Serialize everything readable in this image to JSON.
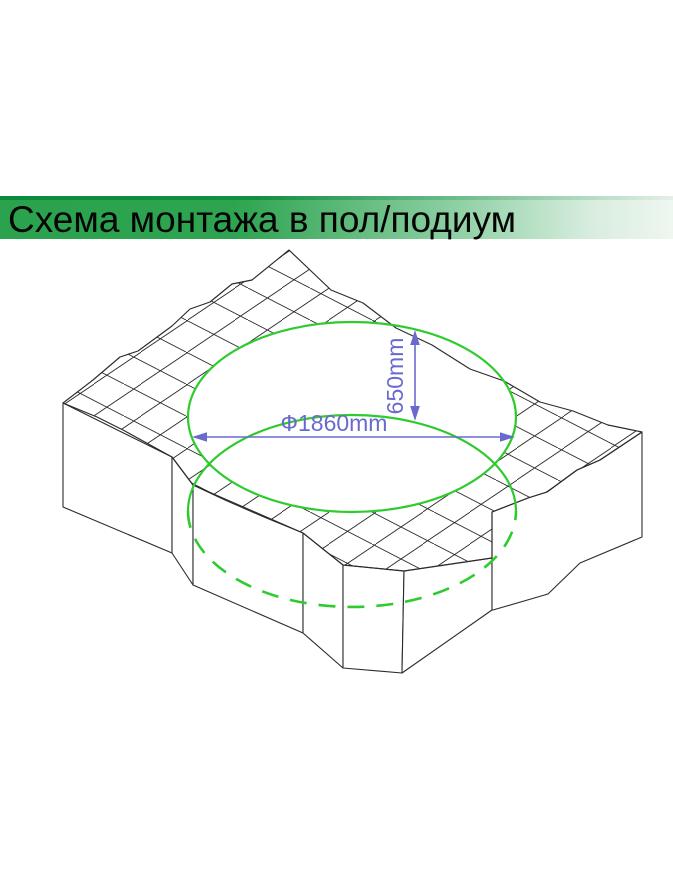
{
  "slide": {
    "title": "Схема монтажа в пол/подиум"
  },
  "diagram": {
    "diameter_label": "Ф1860mm",
    "depth_label": "650mm"
  },
  "colors": {
    "banner_green": "#2BA24E",
    "banner_green_dark": "#0A8B3B",
    "banner_fade": "#EEF6F0",
    "outline_green": "#2ECB2E",
    "dimension_blue": "#6A6ACE",
    "line_color": "#2B2B2B",
    "background": "#FFFFFF"
  }
}
